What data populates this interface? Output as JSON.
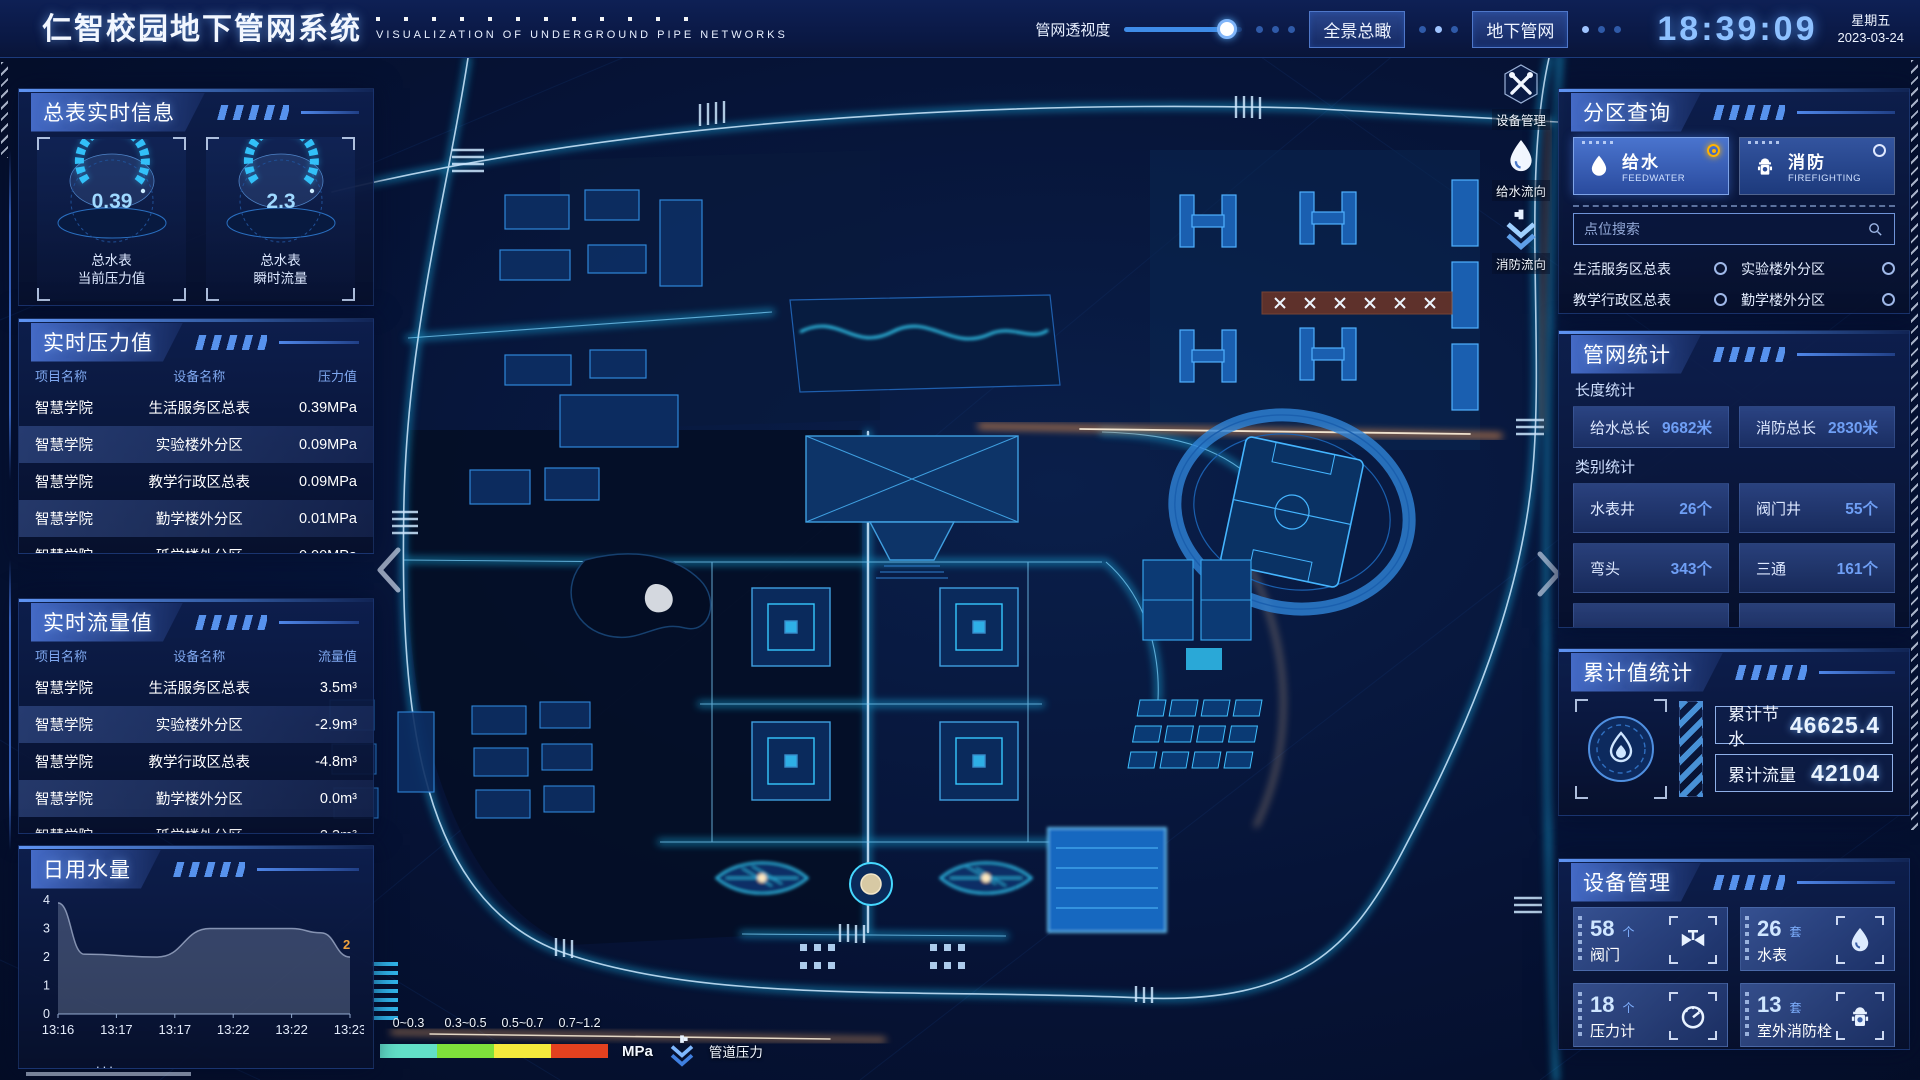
{
  "header": {
    "title": "仁智校园地下管网系统",
    "subtitle": "VISUALIZATION OF UNDERGROUND PIPE NETWORKS",
    "slider_label": "管网透视度",
    "slider_percent": 87,
    "buttons": {
      "overview": "全景总瞰",
      "underground": "地下管网"
    },
    "clock": {
      "time": "18:39:09",
      "weekday": "星期五",
      "date": "2023-03-24"
    }
  },
  "meter_panel": {
    "title": "总表实时信息",
    "gauges": [
      {
        "value": "0.39",
        "label1": "总水表",
        "label2": "当前压力值"
      },
      {
        "value": "2.3",
        "label1": "总水表",
        "label2": "瞬时流量"
      }
    ]
  },
  "pressure_panel": {
    "title": "实时压力值",
    "columns": [
      "项目名称",
      "设备名称",
      "压力值"
    ],
    "rows": [
      {
        "project": "智慧学院",
        "device": "生活服务区总表",
        "value": "0.39MPa"
      },
      {
        "project": "智慧学院",
        "device": "实验楼外分区",
        "value": "0.09MPa"
      },
      {
        "project": "智慧学院",
        "device": "教学行政区总表",
        "value": "0.09MPa"
      },
      {
        "project": "智慧学院",
        "device": "勤学楼外分区",
        "value": "0.01MPa"
      },
      {
        "project": "智慧学院",
        "device": "砥学楼外分区",
        "value": "0.00MPa"
      }
    ]
  },
  "flow_panel": {
    "title": "实时流量值",
    "columns": [
      "项目名称",
      "设备名称",
      "流量值"
    ],
    "rows": [
      {
        "project": "智慧学院",
        "device": "生活服务区总表",
        "value": "3.5m³"
      },
      {
        "project": "智慧学院",
        "device": "实验楼外分区",
        "value": "-2.9m³"
      },
      {
        "project": "智慧学院",
        "device": "教学行政区总表",
        "value": "-4.8m³"
      },
      {
        "project": "智慧学院",
        "device": "勤学楼外分区",
        "value": "0.0m³"
      },
      {
        "project": "智慧学院",
        "device": "砥学楼外分区",
        "value": "2.3m³"
      }
    ]
  },
  "daily_panel": {
    "title": "日用水量"
  },
  "chart_data": {
    "type": "area",
    "title": "日用水量",
    "categories": [
      "13:16",
      "13:17",
      "13:17",
      "13:22",
      "13:22",
      "13:23"
    ],
    "points": [
      [
        0,
        3.9
      ],
      [
        0.45,
        2.1
      ],
      [
        1.7,
        2.0
      ],
      [
        2.6,
        3.0
      ],
      [
        4.0,
        3.0
      ],
      [
        4.5,
        2.85
      ],
      [
        5,
        2.0
      ]
    ],
    "yticks": [
      0,
      1,
      2,
      3,
      4
    ],
    "ylim": [
      0,
      4
    ],
    "grid": false,
    "end_label": "2",
    "end_label_color": "#f0a23c"
  },
  "zone_panel": {
    "title": "分区查询",
    "modes": [
      {
        "cn": "给水",
        "en": "FEEDWATER",
        "icon": "water-drop-icon",
        "selected": true
      },
      {
        "cn": "消防",
        "en": "FIREFIGHTING",
        "icon": "hydrant-icon",
        "selected": false
      }
    ],
    "search_placeholder": "点位搜索",
    "items": [
      "生活服务区总表",
      "实验楼外分区",
      "教学行政区总表",
      "勤学楼外分区",
      "砥学楼外分区",
      "宿舍区泵房"
    ]
  },
  "network_panel": {
    "title": "管网统计",
    "sections": [
      {
        "name": "长度统计",
        "stats": [
          {
            "label": "给水总长",
            "value": "9682米"
          },
          {
            "label": "消防总长",
            "value": "2830米"
          }
        ]
      },
      {
        "name": "类别统计",
        "stats": [
          {
            "label": "水表井",
            "value": "26个"
          },
          {
            "label": "阀门井",
            "value": "55个"
          },
          {
            "label": "弯头",
            "value": "343个"
          },
          {
            "label": "三通",
            "value": "161个"
          }
        ]
      }
    ]
  },
  "cumulative_panel": {
    "title": "累计值统计",
    "rows": [
      {
        "label": "累计节水",
        "value": "46625.4"
      },
      {
        "label": "累计流量",
        "value": "42104"
      }
    ]
  },
  "device_panel": {
    "title": "设备管理",
    "cards": [
      {
        "count": "58",
        "unit": "个",
        "name": "阀门",
        "icon": "valve-icon"
      },
      {
        "count": "26",
        "unit": "套",
        "name": "水表",
        "icon": "water-meter-icon"
      },
      {
        "count": "18",
        "unit": "个",
        "name": "压力计",
        "icon": "pressure-gauge-icon"
      },
      {
        "count": "13",
        "unit": "套",
        "name": "室外消防栓",
        "icon": "hydrant-icon"
      }
    ]
  },
  "map": {
    "tools": [
      {
        "label": "设备管理",
        "icon": "tools-icon"
      },
      {
        "label": "给水流向",
        "icon": "water-drop-icon"
      },
      {
        "label": "消防流向",
        "icon": "flow-arrows-icon"
      }
    ],
    "legend": {
      "ranges": [
        "0~0.3",
        "0.3~0.5",
        "0.5~0.7",
        "0.7~1.2"
      ],
      "colors": [
        "#62dfc8",
        "#7ee03b",
        "#f3e93c",
        "#e3411f"
      ],
      "unit": "MPa",
      "label": "管道压力"
    }
  },
  "colors": {
    "accent": "#3f7fe0",
    "cyan": "#35c7ff",
    "orange": "#ffb300"
  }
}
